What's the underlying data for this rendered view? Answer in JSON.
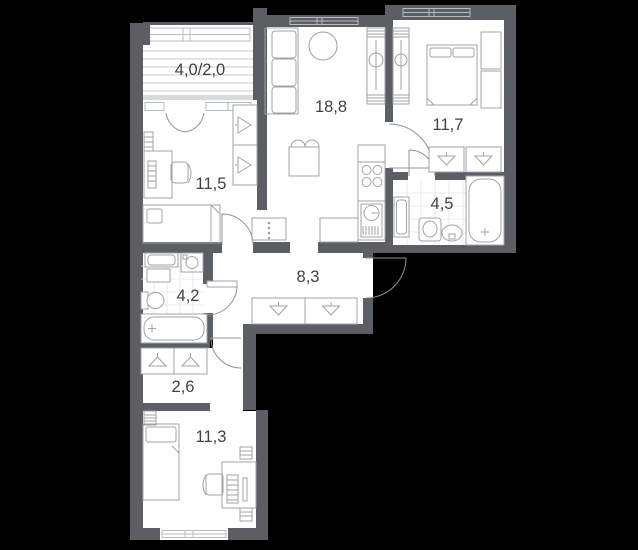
{
  "plan": {
    "title": "apartment-floor-plan",
    "rooms": [
      {
        "id": "balcony",
        "area_label": "4,0/2,0"
      },
      {
        "id": "room-11-5",
        "area_label": "11,5"
      },
      {
        "id": "living-kitchen",
        "area_label": "18,8"
      },
      {
        "id": "bedroom",
        "area_label": "11,7"
      },
      {
        "id": "bathroom-main",
        "area_label": "4,5"
      },
      {
        "id": "hallway",
        "area_label": "8,3"
      },
      {
        "id": "bathroom-small",
        "area_label": "4,2"
      },
      {
        "id": "corridor",
        "area_label": "2,6"
      },
      {
        "id": "room-11-3",
        "area_label": "11,3"
      }
    ]
  },
  "colors": {
    "bg": "#000000",
    "wall": "#5b5e62",
    "floor": "#ffffff",
    "sill": "#d8dadb",
    "fline": "#9fa3a5",
    "tile": "#e3e5e6",
    "hatch": "#c9cbcc",
    "winf": "#b9bcbe",
    "door": "#8f9395",
    "text": "#3f4245"
  }
}
